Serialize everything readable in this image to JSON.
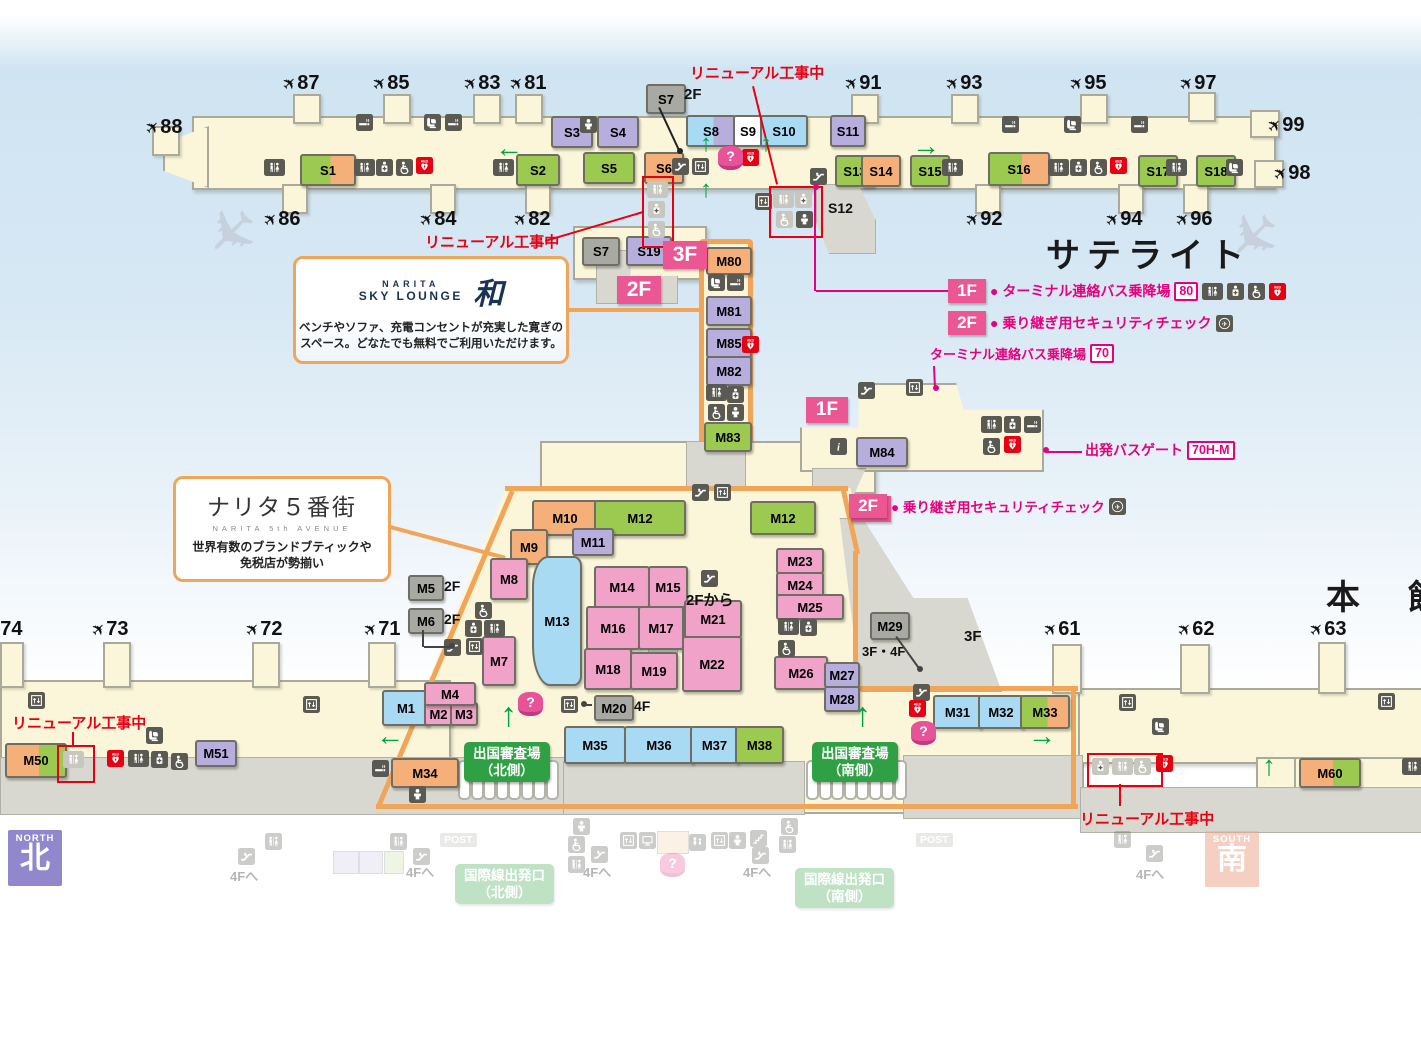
{
  "palette": {
    "g": "#9cc94f",
    "o": "#f4b078",
    "p": "#b7aedd",
    "k": "#f0a2c8",
    "b": "#a9daf3",
    "y": "#a9a9a3",
    "w": "#ffffff",
    "accent_pink": "#e5017d",
    "badge_pink": "#ea5792",
    "construction_red": "#e60012",
    "zone_orange": "#f0a558",
    "guide_green": "#2fa043"
  },
  "area_titles": [
    {
      "text": "サテライト",
      "x": 1046,
      "y": 228
    },
    {
      "text": "本　館",
      "x": 1326,
      "y": 570
    }
  ],
  "corner_badges": {
    "north": {
      "en": "NORTH",
      "jp": "北",
      "x": 8,
      "y": 830,
      "color": "#9187cc",
      "faded": false
    },
    "south": {
      "en": "SOUTH",
      "jp": "南",
      "x": 1205,
      "y": 831,
      "color": "#edaa92",
      "faded": true
    }
  },
  "callouts": {
    "sky_lounge": {
      "x": 293,
      "y": 256,
      "w": 270,
      "h": 102,
      "brand_top": "NARITA",
      "brand_bottom": "SKY LOUNGE",
      "brand_mark": "和",
      "desc1": "ベンチやソファ、充電コンセントが充実した寛ぎの",
      "desc2": "スペース。どなたでも無料でご利用いただけます。"
    },
    "fifth_avenue": {
      "x": 173,
      "y": 476,
      "w": 212,
      "h": 100,
      "jp": "ナリタ５番街",
      "en": "NARITA 5th AVENUE",
      "desc1": "世界有数のブランドブティックや",
      "desc2": "免税店が勢揃い"
    }
  },
  "legend": {
    "row1": {
      "floor": "1F",
      "text": "● ターミナル連絡バス乗降場",
      "badge": "80",
      "icons": [
        "toilet",
        "firstaid",
        "wheelchair",
        "aed"
      ],
      "x": 948,
      "y": 279
    },
    "row2": {
      "floor": "2F",
      "text": "● 乗り継ぎ用セキュリティチェック",
      "icons": [
        "transfer"
      ],
      "x": 948,
      "y": 311
    },
    "security2f": {
      "floor": "2F",
      "text": "● 乗り継ぎ用セキュリティチェック",
      "icons": [
        "transfer"
      ],
      "x": 849,
      "y": 494
    },
    "bus70": {
      "text": "ターミナル連絡バス乗降場",
      "badge": "70",
      "x": 930,
      "y": 344
    },
    "busgate": {
      "text": "出発バスゲート",
      "badge": "70H-M",
      "x": 1085,
      "y": 440
    }
  },
  "floor_badges": [
    {
      "t": "3F",
      "x": 663,
      "y": 241,
      "w": 44,
      "h": 28,
      "fs": 21
    },
    {
      "t": "2F",
      "x": 617,
      "y": 276,
      "w": 44,
      "h": 28,
      "fs": 21
    },
    {
      "t": "1F",
      "x": 806,
      "y": 397,
      "w": 42,
      "h": 26,
      "fs": 19
    },
    {
      "t": "2F",
      "x": 851,
      "y": 496,
      "w": 40,
      "h": 26,
      "fs": 19
    }
  ],
  "construction_labels": [
    {
      "text": "リニューアル工事中",
      "x": 690,
      "y": 62
    },
    {
      "text": "リニューアル工事中",
      "x": 425,
      "y": 231
    },
    {
      "text": "リニューアル工事中",
      "x": 12,
      "y": 712
    },
    {
      "text": "リニューアル工事中",
      "x": 1080,
      "y": 808
    }
  ],
  "small_labels": [
    {
      "text": "2F",
      "x": 684,
      "y": 86,
      "fs": 15
    },
    {
      "text": "2F",
      "x": 444,
      "y": 578,
      "fs": 14
    },
    {
      "text": "2F",
      "x": 444,
      "y": 611,
      "fs": 14
    },
    {
      "text": "2Fから",
      "x": 686,
      "y": 589,
      "fs": 15
    },
    {
      "text": "3F",
      "x": 964,
      "y": 628,
      "fs": 15
    },
    {
      "text": "3F・4F",
      "x": 862,
      "y": 641,
      "fs": 13
    },
    {
      "text": "4F",
      "x": 634,
      "y": 698,
      "fs": 14
    },
    {
      "text": "S12",
      "x": 828,
      "y": 200,
      "fs": 14
    }
  ],
  "gates": [
    {
      "n": "87",
      "x": 283,
      "y": 72
    },
    {
      "n": "85",
      "x": 373,
      "y": 72
    },
    {
      "n": "83",
      "x": 464,
      "y": 72
    },
    {
      "n": "81",
      "x": 510,
      "y": 72
    },
    {
      "n": "88",
      "x": 146,
      "y": 116
    },
    {
      "n": "86",
      "x": 264,
      "y": 208
    },
    {
      "n": "84",
      "x": 420,
      "y": 208
    },
    {
      "n": "82",
      "x": 514,
      "y": 208
    },
    {
      "n": "91",
      "x": 845,
      "y": 72
    },
    {
      "n": "93",
      "x": 946,
      "y": 72
    },
    {
      "n": "95",
      "x": 1070,
      "y": 72
    },
    {
      "n": "97",
      "x": 1180,
      "y": 72
    },
    {
      "n": "99",
      "x": 1268,
      "y": 114
    },
    {
      "n": "98",
      "x": 1274,
      "y": 162
    },
    {
      "n": "92",
      "x": 966,
      "y": 208
    },
    {
      "n": "94",
      "x": 1106,
      "y": 208
    },
    {
      "n": "96",
      "x": 1176,
      "y": 208
    },
    {
      "n": "74",
      "x": -14,
      "y": 618
    },
    {
      "n": "73",
      "x": 92,
      "y": 618
    },
    {
      "n": "72",
      "x": 246,
      "y": 618
    },
    {
      "n": "71",
      "x": 364,
      "y": 618
    },
    {
      "n": "61",
      "x": 1044,
      "y": 618
    },
    {
      "n": "62",
      "x": 1178,
      "y": 618
    },
    {
      "n": "63",
      "x": 1310,
      "y": 618
    }
  ],
  "shops": [
    [
      "S1",
      300,
      154,
      52,
      28,
      "go"
    ],
    [
      "S2",
      516,
      154,
      40,
      28,
      "g"
    ],
    [
      "S3",
      551,
      116,
      38,
      28,
      "p"
    ],
    [
      "S4",
      597,
      116,
      38,
      28,
      "p"
    ],
    [
      "S5",
      583,
      152,
      48,
      28,
      "g"
    ],
    [
      "S6",
      644,
      152,
      36,
      28,
      "o"
    ],
    [
      "S7",
      646,
      84,
      36,
      26,
      "y"
    ],
    [
      "S8",
      686,
      115,
      46,
      28,
      "bp"
    ],
    [
      "S9",
      733,
      115,
      26,
      28,
      "w"
    ],
    [
      "S10",
      760,
      115,
      44,
      28,
      "b"
    ],
    [
      "S11",
      830,
      115,
      32,
      28,
      "p"
    ],
    [
      "S13",
      835,
      155,
      36,
      28,
      "g"
    ],
    [
      "S14",
      861,
      155,
      36,
      28,
      "o"
    ],
    [
      "S15",
      910,
      155,
      36,
      28,
      "g"
    ],
    [
      "S16",
      988,
      152,
      58,
      30,
      "go"
    ],
    [
      "S17",
      1138,
      155,
      36,
      28,
      "g"
    ],
    [
      "S18",
      1196,
      155,
      36,
      28,
      "g"
    ],
    [
      "S19",
      626,
      236,
      42,
      26,
      "p"
    ],
    [
      "S7",
      582,
      237,
      34,
      25,
      "y"
    ],
    [
      "M80",
      706,
      247,
      42,
      24,
      "o"
    ],
    [
      "M81",
      706,
      296,
      42,
      26,
      "p"
    ],
    [
      "M85",
      706,
      328,
      42,
      26,
      "p"
    ],
    [
      "M82",
      706,
      356,
      42,
      26,
      "p"
    ],
    [
      "M83",
      704,
      422,
      44,
      26,
      "g"
    ],
    [
      "M84",
      856,
      437,
      48,
      26,
      "p"
    ],
    [
      "M10",
      532,
      500,
      62,
      32,
      "o"
    ],
    [
      "M12",
      594,
      500,
      88,
      32,
      "g"
    ],
    [
      "M11",
      572,
      528,
      38,
      24,
      "p"
    ],
    [
      "M9",
      510,
      529,
      34,
      32,
      "o"
    ],
    [
      "M8",
      490,
      558,
      34,
      38,
      "k"
    ],
    [
      "M5",
      408,
      575,
      32,
      22,
      "y"
    ],
    [
      "M6",
      408,
      608,
      32,
      22,
      "y"
    ],
    [
      "M7",
      482,
      636,
      30,
      46,
      "k"
    ],
    [
      "M13",
      532,
      556,
      46,
      126,
      "b"
    ],
    [
      "M14",
      594,
      566,
      52,
      38,
      "k"
    ],
    [
      "M15",
      648,
      566,
      36,
      38,
      "k"
    ],
    [
      "M16",
      586,
      606,
      50,
      40,
      "k"
    ],
    [
      "M17",
      638,
      606,
      42,
      40,
      "k"
    ],
    [
      "M18",
      584,
      648,
      44,
      38,
      "k"
    ],
    [
      "M19",
      630,
      652,
      44,
      34,
      "k"
    ],
    [
      "M21",
      684,
      600,
      54,
      34,
      "k"
    ],
    [
      "M22",
      682,
      636,
      56,
      52,
      "k"
    ],
    [
      "M23",
      776,
      548,
      44,
      22,
      "k"
    ],
    [
      "M24",
      776,
      572,
      44,
      22,
      "k"
    ],
    [
      "M25",
      776,
      594,
      64,
      22,
      "k"
    ],
    [
      "M26",
      774,
      656,
      50,
      30,
      "k"
    ],
    [
      "M27",
      824,
      662,
      32,
      22,
      "p"
    ],
    [
      "M28",
      824,
      686,
      32,
      22,
      "p"
    ],
    [
      "M29",
      870,
      612,
      36,
      24,
      "y"
    ],
    [
      "M12",
      750,
      501,
      62,
      30,
      "g"
    ],
    [
      "M20",
      594,
      695,
      36,
      22,
      "y"
    ],
    [
      "M1",
      382,
      690,
      44,
      32,
      "b"
    ],
    [
      "M2",
      424,
      702,
      25,
      20,
      "k"
    ],
    [
      "M3",
      450,
      702,
      24,
      20,
      "k"
    ],
    [
      "M4",
      424,
      682,
      48,
      20,
      "k"
    ],
    [
      "M31",
      933,
      695,
      45,
      30,
      "b"
    ],
    [
      "M32",
      978,
      695,
      42,
      30,
      "b"
    ],
    [
      "M33",
      1020,
      695,
      46,
      30,
      "go"
    ],
    [
      "M34",
      391,
      758,
      64,
      26,
      "o"
    ],
    [
      "M35",
      564,
      726,
      58,
      34,
      "b"
    ],
    [
      "M36",
      624,
      726,
      66,
      34,
      "b"
    ],
    [
      "M37",
      690,
      726,
      45,
      34,
      "b"
    ],
    [
      "M38",
      735,
      726,
      45,
      34,
      "g"
    ],
    [
      "M50",
      5,
      743,
      58,
      31,
      "og"
    ],
    [
      "M51",
      195,
      740,
      38,
      23,
      "p"
    ],
    [
      "M60",
      1299,
      758,
      58,
      26,
      "og"
    ]
  ],
  "icons": [
    [
      "toilet",
      264,
      159
    ],
    [
      "smoking",
      356,
      114
    ],
    [
      "massage",
      424,
      114
    ],
    [
      "smoking",
      445,
      114
    ],
    [
      "toilet",
      354,
      159
    ],
    [
      "firstaid",
      376,
      159
    ],
    [
      "wheelchair",
      396,
      159
    ],
    [
      "aed",
      416,
      157
    ],
    [
      "toilet",
      493,
      159
    ],
    [
      "baby",
      580,
      116
    ],
    [
      "escalator",
      672,
      158
    ],
    [
      "elevator",
      692,
      158
    ],
    [
      "aed",
      742,
      149
    ],
    [
      "toilet",
      647,
      181,
      "d"
    ],
    [
      "firstaid",
      648,
      201,
      "d"
    ],
    [
      "wheelchair",
      648,
      221,
      "d"
    ],
    [
      "elevator",
      755,
      193
    ],
    [
      "toilet",
      773,
      191,
      "d"
    ],
    [
      "firstaid",
      795,
      191,
      "d"
    ],
    [
      "wheelchair",
      776,
      211,
      "d"
    ],
    [
      "baby",
      796,
      211
    ],
    [
      "escalator",
      810,
      168
    ],
    [
      "smoking",
      1002,
      116
    ],
    [
      "massage",
      1064,
      116
    ],
    [
      "smoking",
      1131,
      116
    ],
    [
      "toilet",
      942,
      159
    ],
    [
      "toilet",
      1048,
      159
    ],
    [
      "firstaid",
      1070,
      159
    ],
    [
      "wheelchair",
      1090,
      159
    ],
    [
      "aed",
      1110,
      157
    ],
    [
      "toilet",
      1166,
      159
    ],
    [
      "massage",
      1226,
      159
    ],
    [
      "massage",
      708,
      274
    ],
    [
      "smoking",
      727,
      274
    ],
    [
      "aed",
      742,
      336
    ],
    [
      "toilet",
      706,
      384
    ],
    [
      "firstaid",
      727,
      386
    ],
    [
      "wheelchair",
      708,
      404
    ],
    [
      "baby",
      727,
      404
    ],
    [
      "escalator",
      858,
      382
    ],
    [
      "elevator",
      906,
      379
    ],
    [
      "info",
      830,
      438
    ],
    [
      "toilet",
      981,
      416
    ],
    [
      "firstaid",
      1004,
      416
    ],
    [
      "smoking",
      1024,
      416
    ],
    [
      "wheelchair",
      983,
      438
    ],
    [
      "aed",
      1004,
      436
    ],
    [
      "escalator",
      692,
      484
    ],
    [
      "elevator",
      714,
      484
    ],
    [
      "wheelchair",
      475,
      602
    ],
    [
      "firstaid",
      465,
      620
    ],
    [
      "toilet",
      484,
      620
    ],
    [
      "escalator",
      444,
      639
    ],
    [
      "elevator",
      466,
      638
    ],
    [
      "escalator",
      701,
      570
    ],
    [
      "toilet",
      778,
      618
    ],
    [
      "firstaid",
      800,
      619
    ],
    [
      "wheelchair",
      778,
      640
    ],
    [
      "escalator",
      913,
      684
    ],
    [
      "aed",
      909,
      700
    ],
    [
      "elevator",
      561,
      696
    ],
    [
      "smoking",
      372,
      760
    ],
    [
      "baby",
      409,
      786
    ],
    [
      "massage",
      146,
      727
    ],
    [
      "aed",
      107,
      750
    ],
    [
      "toilet",
      128,
      750
    ],
    [
      "firstaid",
      151,
      751
    ],
    [
      "wheelchair",
      171,
      753
    ],
    [
      "toilet",
      63,
      751,
      "d"
    ],
    [
      "elevator",
      28,
      692
    ],
    [
      "elevator",
      303,
      696
    ],
    [
      "elevator",
      1119,
      694
    ],
    [
      "elevator",
      1378,
      693
    ],
    [
      "massage",
      1152,
      718
    ],
    [
      "firstaid",
      1092,
      758,
      "d"
    ],
    [
      "toilet",
      1112,
      758,
      "d"
    ],
    [
      "wheelchair",
      1134,
      758,
      "d"
    ],
    [
      "aed",
      1156,
      755
    ],
    [
      "toilet",
      1402,
      758
    ]
  ],
  "questions": [
    {
      "x": 718,
      "y": 146
    },
    {
      "x": 911,
      "y": 721
    },
    {
      "x": 518,
      "y": 692
    }
  ],
  "red_boxes": [
    [
      642,
      176,
      28,
      68
    ],
    [
      769,
      186,
      50,
      48
    ],
    [
      57,
      745,
      34,
      34
    ],
    [
      1087,
      753,
      72,
      30
    ]
  ],
  "arrows": [
    {
      "c": "←",
      "x": 495,
      "y": 134,
      "fs": 28
    },
    {
      "c": "→",
      "x": 912,
      "y": 132,
      "fs": 28
    },
    {
      "c": "↑",
      "x": 700,
      "y": 132,
      "fs": 24
    },
    {
      "c": "↑",
      "x": 760,
      "y": 132,
      "fs": 24
    },
    {
      "c": "↑",
      "x": 700,
      "y": 178,
      "fs": 24
    },
    {
      "c": "←",
      "x": 376,
      "y": 722,
      "fs": 28
    },
    {
      "c": "→",
      "x": 1028,
      "y": 722,
      "fs": 28
    },
    {
      "c": "↑",
      "x": 500,
      "y": 698,
      "fs": 34
    },
    {
      "c": "↑",
      "x": 854,
      "y": 698,
      "fs": 34
    },
    {
      "c": "↑",
      "x": 1262,
      "y": 752,
      "fs": 28
    }
  ],
  "departure_badges": [
    {
      "l1": "出国審査場",
      "l2": "（北側）",
      "x": 464,
      "y": 742
    },
    {
      "l1": "出国審査場",
      "l2": "（南側）",
      "x": 812,
      "y": 742
    }
  ],
  "booth_rows": [
    {
      "x": 458,
      "y": 760,
      "n": 8
    },
    {
      "x": 806,
      "y": 760,
      "n": 8
    }
  ],
  "faded_strip": {
    "labels": [
      {
        "text": "POST",
        "x": 440,
        "y": 833,
        "post": true
      },
      {
        "text": "POST",
        "x": 916,
        "y": 833,
        "post": true
      },
      {
        "text": "4Fへ",
        "x": 230,
        "y": 866
      },
      {
        "text": "4Fへ",
        "x": 406,
        "y": 862
      },
      {
        "text": "4Fへ",
        "x": 583,
        "y": 862
      },
      {
        "text": "4Fへ",
        "x": 743,
        "y": 862
      },
      {
        "text": "4Fへ",
        "x": 1136,
        "y": 864
      }
    ],
    "green_badges": [
      {
        "l1": "国際線出発口",
        "l2": "（北側）",
        "x": 455,
        "y": 864
      },
      {
        "l1": "国際線出発口",
        "l2": "（南側）",
        "x": 795,
        "y": 868
      }
    ],
    "icons": [
      [
        "toilet",
        265,
        833
      ],
      [
        "toilet",
        390,
        833
      ],
      [
        "escalator",
        238,
        848
      ],
      [
        "escalator",
        413,
        848
      ],
      [
        "baby",
        573,
        818
      ],
      [
        "wheelchair",
        568,
        836
      ],
      [
        "toilet",
        568,
        856
      ],
      [
        "escalator",
        591,
        846
      ],
      [
        "elevator",
        620,
        832
      ],
      [
        "monitor",
        639,
        832
      ],
      [
        "family",
        689,
        834
      ],
      [
        "elevator",
        711,
        832
      ],
      [
        "baby",
        729,
        832
      ],
      [
        "stairs",
        750,
        830
      ],
      [
        "escalator",
        752,
        847
      ],
      [
        "wheelchair",
        781,
        818
      ],
      [
        "toilet",
        779,
        836
      ],
      [
        "toilet",
        1114,
        831
      ],
      [
        "escalator",
        1146,
        845
      ]
    ],
    "boxes": [
      {
        "x": 333,
        "y": 851,
        "w": 24,
        "h": 21,
        "c": "#cfc8e8"
      },
      {
        "x": 359,
        "y": 851,
        "w": 22,
        "h": 21,
        "c": "#cfc8e8"
      },
      {
        "x": 384,
        "y": 851,
        "w": 18,
        "h": 21,
        "c": "#c8dfa8"
      },
      {
        "x": 657,
        "y": 831,
        "w": 30,
        "h": 21,
        "c": "#f4d2a8"
      }
    ],
    "question": {
      "x": 660,
      "y": 853
    }
  }
}
